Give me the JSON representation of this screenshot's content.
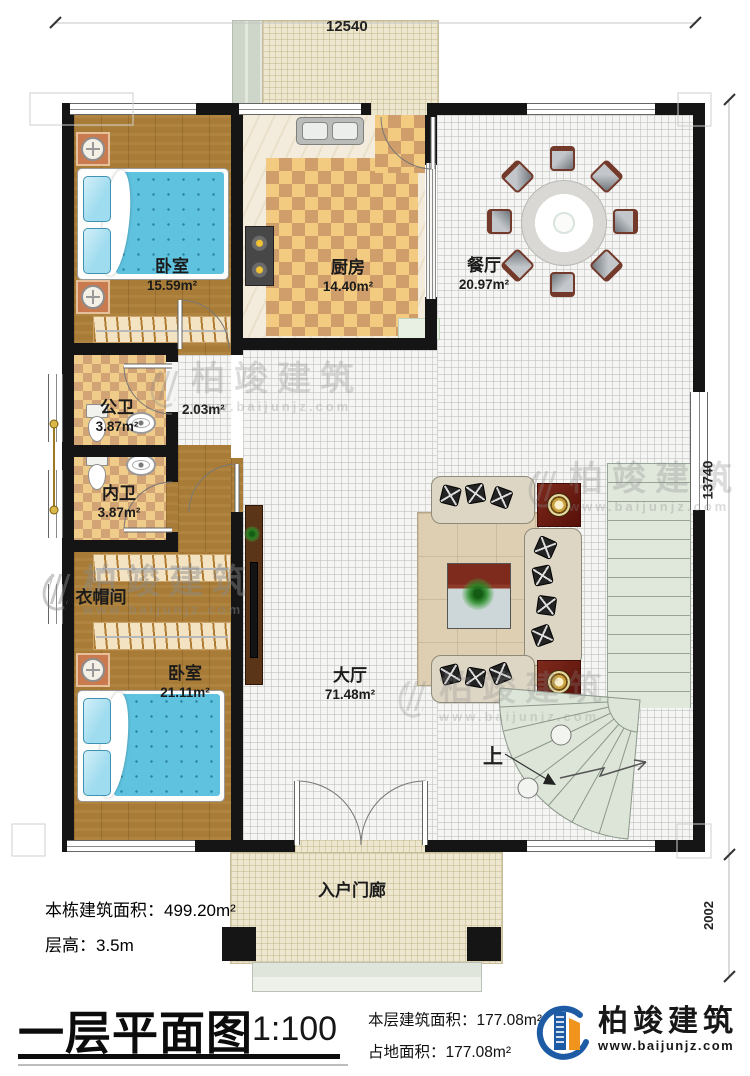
{
  "dimensions": {
    "top_width": "12540",
    "right_height": "13740",
    "porch_height": "2002"
  },
  "rooms": {
    "bedroom1": {
      "name": "卧室",
      "area": "15.59m²"
    },
    "kitchen": {
      "name": "厨房",
      "area": "14.40m²"
    },
    "dining": {
      "name": "餐厅",
      "area": "20.97m²"
    },
    "wc_public": {
      "name": "公卫",
      "area": "3.87m²"
    },
    "wc_private": {
      "name": "内卫",
      "area": "3.87m²"
    },
    "cloakroom": {
      "name": "衣帽间"
    },
    "bedroom2": {
      "name": "卧室",
      "area": "21.11m²"
    },
    "hall": {
      "name": "大厅",
      "area": "71.48m²"
    },
    "corridor": {
      "area": "2.03m²"
    },
    "porch": {
      "name": "入户门廊"
    },
    "stairs": {
      "up_label": "上"
    }
  },
  "notes": {
    "total_building_area": "本栋建筑面积：499.20m²",
    "floor_height": "层高：3.5m"
  },
  "titleblock": {
    "title": "一层平面图",
    "scale": "1:100",
    "floor_area": "本层建筑面积：177.08m²",
    "footprint_area": "占地面积：177.08m²"
  },
  "brand": {
    "name": "柏竣建筑",
    "website": "www.baijunjz.com"
  },
  "colors": {
    "wall": "#151515",
    "wood_floor": "#a87c36",
    "tile_light": "#f2ca80",
    "tile_dark": "#cf9e6b",
    "stair_green": "#e0e7db",
    "bed_blue": "#5fc3e0",
    "brand_blue": "#1d5ca5",
    "brand_orange": "#f0941d",
    "end_table_red": "#7e2a1c"
  }
}
